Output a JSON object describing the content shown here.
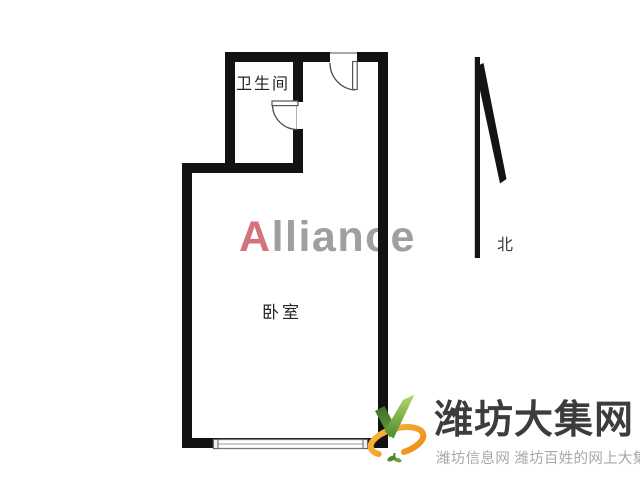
{
  "floorplan": {
    "bathroom_label": "卫生间",
    "bedroom_label": "卧室",
    "compass": {
      "north_label": "北"
    },
    "watermark": {
      "first": "A",
      "rest": "lliance"
    }
  },
  "logo": {
    "title": "潍坊大集网",
    "subtitle": "潍坊信息网 潍坊百姓的网上大集"
  },
  "colors": {
    "wall": "#121212",
    "watermark_accent": "#d4737e",
    "watermark_gray": "#9f9f9f",
    "logo_title": "#3c3c3c",
    "logo_subtitle": "#a8a8a8",
    "logo_green_dark": "#4e8a2c",
    "logo_green_light": "#b2d96a",
    "logo_orange": "#f59e2f"
  }
}
